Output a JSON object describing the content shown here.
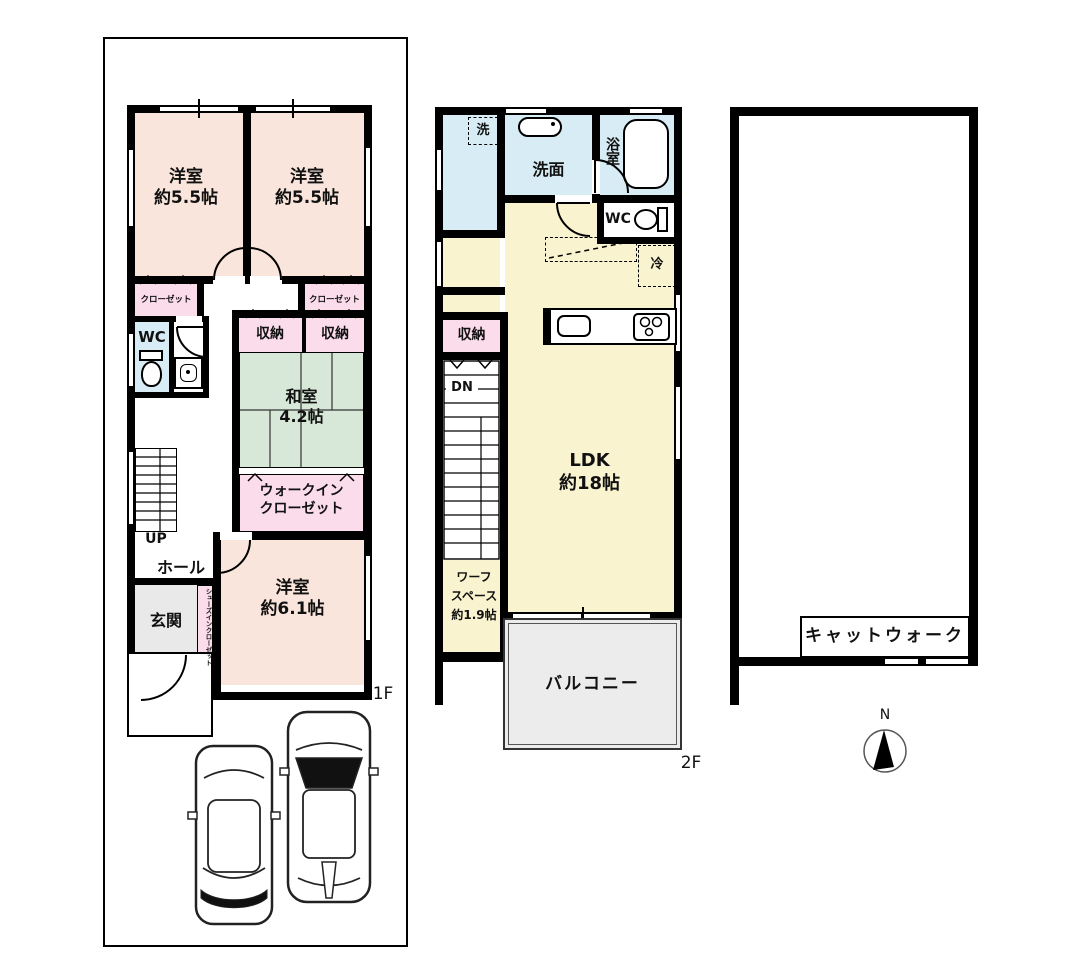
{
  "floor1": {
    "floor_label": "1F",
    "bedroom_a": {
      "line1": "洋室",
      "line2": "約5.5帖"
    },
    "bedroom_b": {
      "line1": "洋室",
      "line2": "約5.5帖"
    },
    "closet_a": "クローゼット",
    "closet_b": "クローゼット",
    "wc": "WC",
    "storage_a": "収納",
    "storage_b": "収納",
    "washitsu": {
      "line1": "和室",
      "line2": "4.2帖"
    },
    "walkin_closet": {
      "line1": "ウォークイン",
      "line2": "クローゼット"
    },
    "stairs_up": "UP",
    "hall": "ホール",
    "genkan": "玄関",
    "shoes_closet": "シューズインクローゼット",
    "bedroom_c": {
      "line1": "洋室",
      "line2": "約6.1帖"
    }
  },
  "floor2": {
    "floor_label": "2F",
    "laundry": "洗",
    "washroom": "洗面",
    "bathroom": "浴室",
    "wc": "WC",
    "fridge": "冷",
    "storage": "収納",
    "stairs_down": "DN",
    "ldk": {
      "line1": "LDK",
      "line2": "約18帖"
    },
    "work_space": {
      "line1": "ワーフ",
      "line2": "スペース",
      "line3": "約1.9帖"
    },
    "balcony": "バルコニー"
  },
  "floor3": {
    "catwalk": "キャットウォーク"
  },
  "compass": {
    "north": "N"
  },
  "colors": {
    "wall": "#000000",
    "bedroom_pink": "#f9e5db",
    "closet_pink": "#fbdcea",
    "water_blue": "#d8ecf5",
    "tatami_green": "#d8e8d8",
    "ldk_cream": "#faf3cf",
    "balcony_gray": "#ececec",
    "genkan_gray": "#e9e9e9"
  }
}
